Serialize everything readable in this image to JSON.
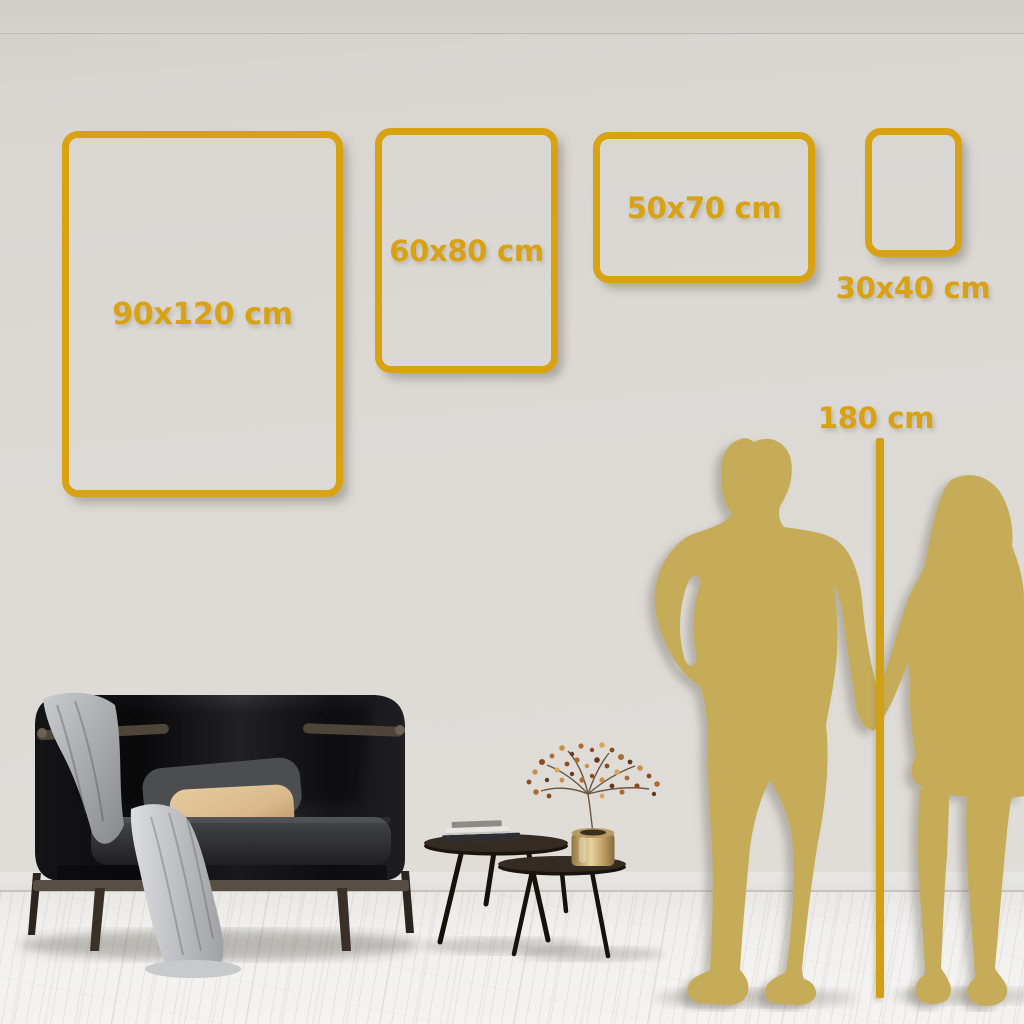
{
  "scene_type": "wall-art-size-guide",
  "frames": [
    {
      "label": "90x120 cm"
    },
    {
      "label": "60x80 cm"
    },
    {
      "label": "50x70 cm"
    },
    {
      "label": "30x40 cm"
    }
  ],
  "height_reference": {
    "label": "180 cm"
  },
  "colors": {
    "accent_gold": "#d8a213",
    "line_gold": "#d2a015",
    "silhouette_gold": "#c6ac58",
    "wall_gray": "#dcd9d5",
    "floor_white": "#f1f0ee",
    "sofa_charcoal": "#1a1a1d",
    "pillow_tan": "#d9b98c",
    "blanket_gray": "#c3c5c7"
  }
}
